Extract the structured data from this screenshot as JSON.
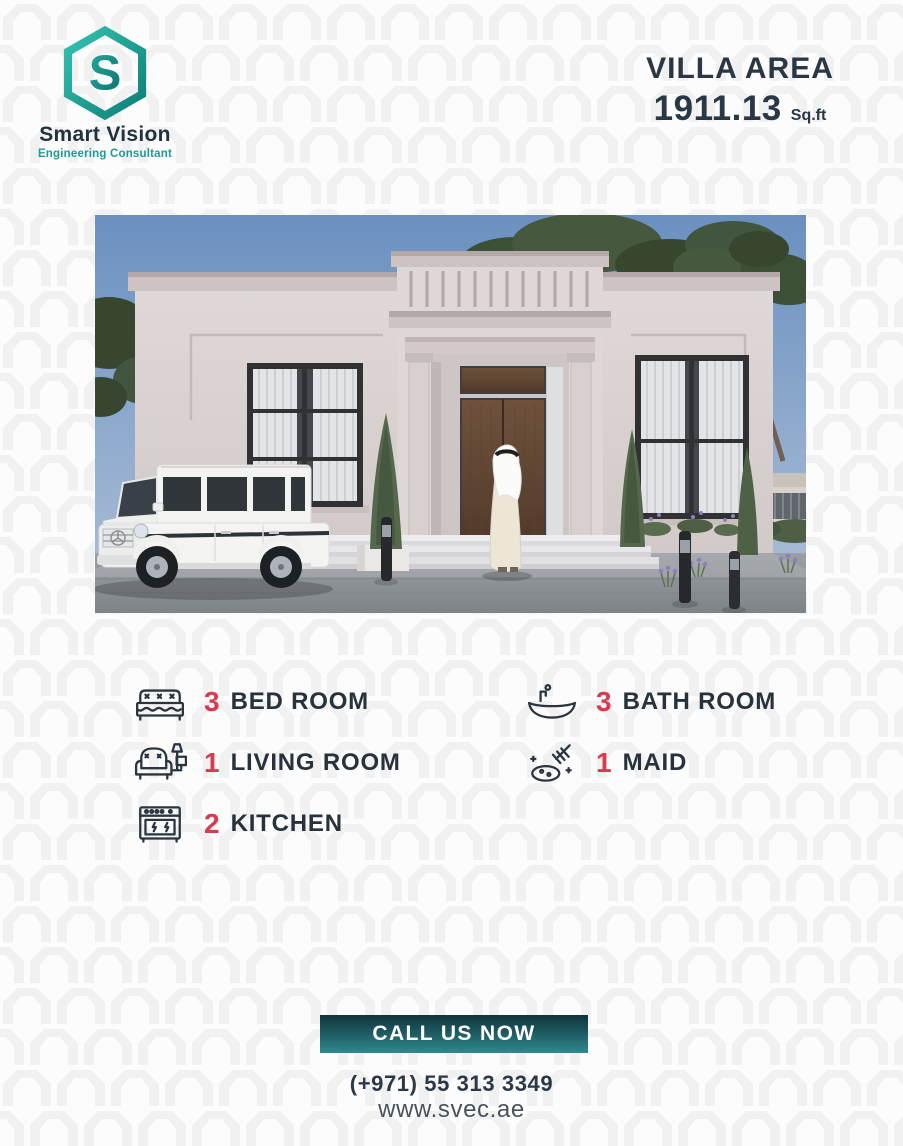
{
  "brand": {
    "name": "Smart Vision",
    "tagline": "Engineering Consultant",
    "logo_letter": "S",
    "colors": {
      "teal": "#1FA396",
      "teal_dark": "#0F7F78",
      "navy": "#21323F"
    }
  },
  "header": {
    "title": "VILLA AREA",
    "area_value": "1911.13",
    "area_unit": "Sq.ft"
  },
  "villa_image": {
    "alt": "3D exterior render of a classical single-storey villa with a white SUV parked in front, cypress trees, bollard lights and a man in a white kandura walking toward the wooden entrance door",
    "colors": {
      "sky": "#6B90C0",
      "facade": "#DCD5D4",
      "door": "#64462F",
      "paving": "#8E9296"
    }
  },
  "features": [
    {
      "count": "3",
      "label": "BED ROOM",
      "icon": "bed-icon"
    },
    {
      "count": "3",
      "label": "BATH ROOM",
      "icon": "bathtub-icon"
    },
    {
      "count": "1",
      "label": "LIVING ROOM",
      "icon": "armchair-lamp-icon"
    },
    {
      "count": "1",
      "label": "MAID",
      "icon": "cleaning-icon"
    },
    {
      "count": "2",
      "label": "KITCHEN",
      "icon": "stove-icon"
    }
  ],
  "footer": {
    "cta_label": "CALL US NOW",
    "phone": "(+971) 55 313 3349",
    "website": "www.svec.ae"
  },
  "colors": {
    "accent_red": "#D93A4E",
    "text_navy": "#2A3540",
    "button_top": "#0F353C",
    "button_bottom": "#2F8A8E",
    "background": "#FCFCFC",
    "pattern": "#F1F1F1"
  }
}
